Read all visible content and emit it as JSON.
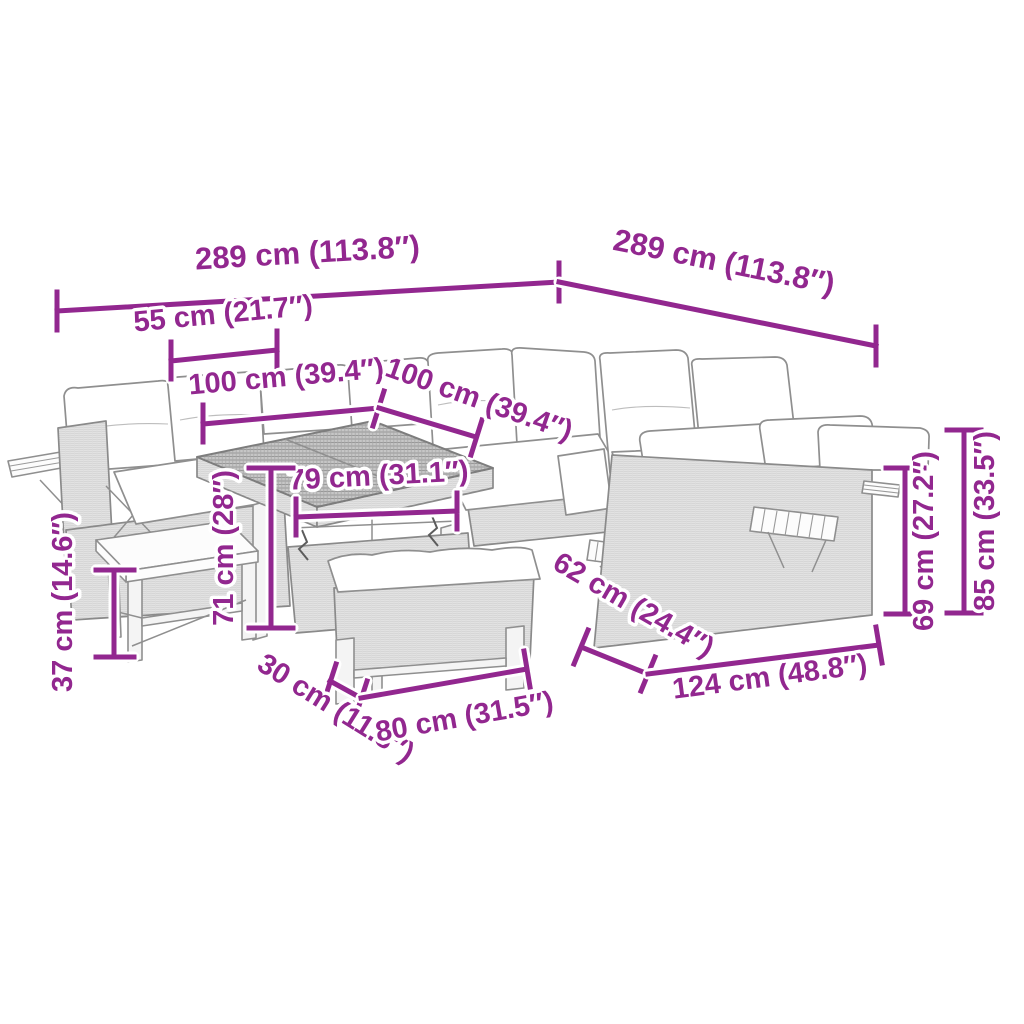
{
  "title": "Garden furniture set — dimension diagram",
  "colors": {
    "dimension": "#92278F",
    "line_art": "#8f8f8f",
    "background": "#ffffff"
  },
  "dimensions": {
    "overall_left": "289 cm (113.8″)",
    "overall_right": "289 cm (113.8″)",
    "armrest_width": "55 cm (21.7″)",
    "sofa_width_left": "100 cm (39.4″)",
    "sofa_width_right": "100 cm (39.4″)",
    "table_inner_width": "79 cm (31.1″)",
    "table_height": "71 cm (28″)",
    "stool_height": "37 cm (14.6″)",
    "bench_depth": "30 cm (11.8″)",
    "bench_width": "80 cm (31.5″)",
    "sofa_depth": "62 cm (24.4″)",
    "sofa_module_width": "124 cm (48.8″)",
    "seat_height": "69 cm (27.2″)",
    "back_height": "85 cm (33.5″)"
  }
}
